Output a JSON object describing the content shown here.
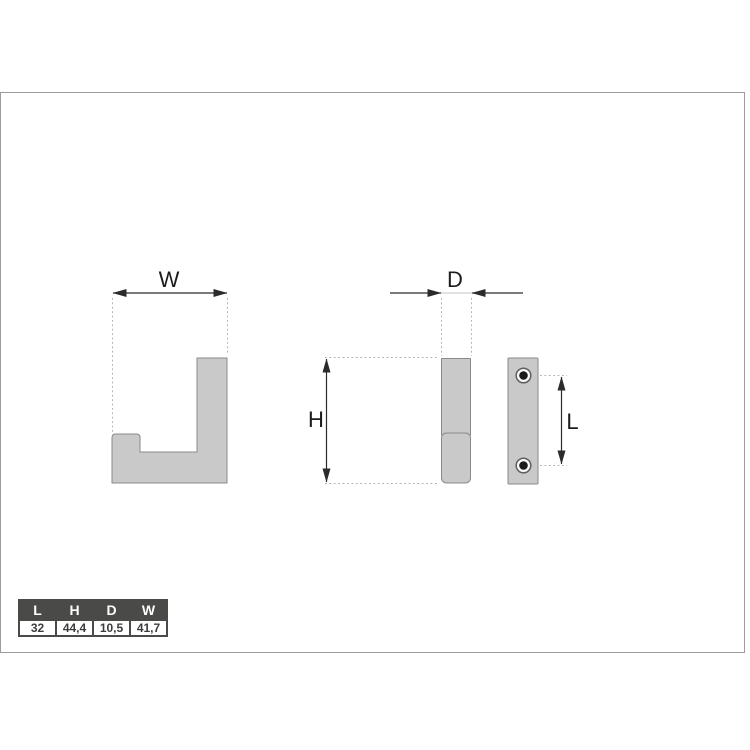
{
  "drawing": {
    "dimension_labels": {
      "width": "W",
      "depth": "D",
      "height": "H",
      "hole_spacing": "L"
    }
  },
  "table": {
    "headers": [
      "L",
      "H",
      "D",
      "W"
    ],
    "values": [
      "32",
      "44,4",
      "10,5",
      "41,7"
    ]
  },
  "colors": {
    "part_fill": "#c9c9c9",
    "part_stroke": "#8a8a8a",
    "dim_line": "#2b2b2b",
    "ext_line": "#b0b0b0",
    "canvas_border": "#9c9c9c",
    "table_frame": "#4a4a49",
    "table_header_text": "#ffffff",
    "table_value_bg": "#ffffff",
    "table_value_text": "#3c3c3c",
    "label_color": "#1c1c1c"
  }
}
